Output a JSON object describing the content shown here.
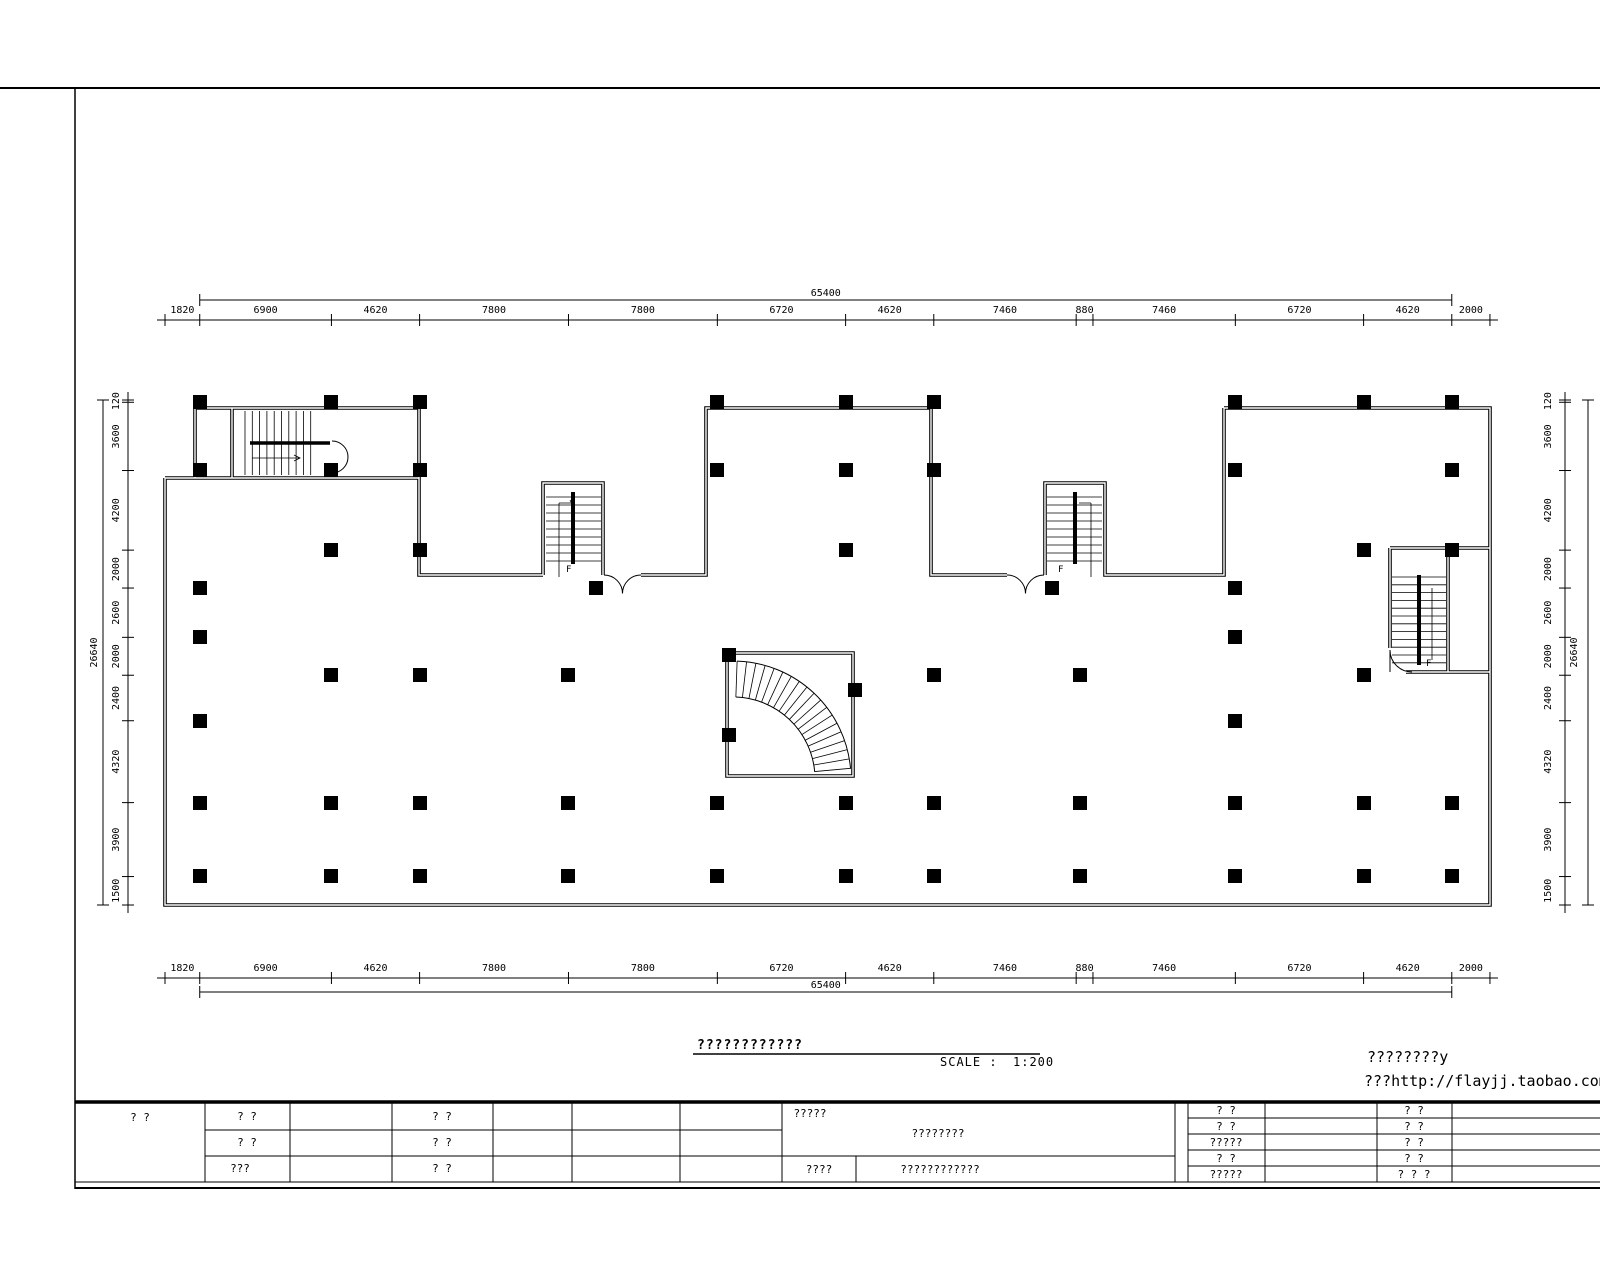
{
  "sheet": {
    "drawing_title": "????????????",
    "scale_label": "SCALE :",
    "scale_value": "1:200"
  },
  "watermark": {
    "line1": "????????y",
    "line2": "???http://flayjj.taobao.com"
  },
  "dimensions": {
    "top": {
      "overall": "65400",
      "segments": [
        1820,
        6900,
        4620,
        7800,
        7800,
        6720,
        4620,
        7460,
        880,
        7460,
        6720,
        4620,
        2000
      ]
    },
    "bottom": {
      "overall": "65400",
      "segments": [
        1820,
        6900,
        4620,
        7800,
        7800,
        6720,
        4620,
        7460,
        880,
        7460,
        6720,
        4620,
        2000
      ]
    },
    "left": {
      "overall": "26640",
      "segments": [
        120,
        3600,
        4200,
        2000,
        2600,
        2000,
        2400,
        4320,
        3900,
        1500
      ]
    },
    "right": {
      "overall": "26640",
      "segments": [
        120,
        3600,
        4200,
        2000,
        2600,
        2000,
        2400,
        4320,
        3900,
        1500
      ]
    }
  },
  "plan": {
    "stair_up_label": "F",
    "columns_px": [
      [
        200,
        402
      ],
      [
        331,
        402
      ],
      [
        420,
        402
      ],
      [
        717,
        402
      ],
      [
        846,
        402
      ],
      [
        934,
        402
      ],
      [
        1235,
        402
      ],
      [
        1364,
        402
      ],
      [
        1452,
        402
      ],
      [
        200,
        470
      ],
      [
        331,
        470
      ],
      [
        420,
        470
      ],
      [
        717,
        470
      ],
      [
        846,
        470
      ],
      [
        934,
        470
      ],
      [
        1235,
        470
      ],
      [
        1452,
        470
      ],
      [
        331,
        550
      ],
      [
        420,
        550
      ],
      [
        846,
        550
      ],
      [
        1364,
        550
      ],
      [
        1452,
        550
      ],
      [
        200,
        588
      ],
      [
        596,
        588
      ],
      [
        1052,
        588
      ],
      [
        1235,
        588
      ],
      [
        200,
        637
      ],
      [
        1235,
        637
      ],
      [
        331,
        675
      ],
      [
        420,
        675
      ],
      [
        568,
        675
      ],
      [
        934,
        675
      ],
      [
        1080,
        675
      ],
      [
        1364,
        675
      ],
      [
        200,
        721
      ],
      [
        1235,
        721
      ],
      [
        729,
        655
      ],
      [
        729,
        735
      ],
      [
        855,
        690
      ],
      [
        200,
        803
      ],
      [
        331,
        803
      ],
      [
        420,
        803
      ],
      [
        568,
        803
      ],
      [
        717,
        803
      ],
      [
        846,
        803
      ],
      [
        934,
        803
      ],
      [
        1080,
        803
      ],
      [
        1235,
        803
      ],
      [
        1364,
        803
      ],
      [
        1452,
        803
      ],
      [
        200,
        876
      ],
      [
        331,
        876
      ],
      [
        420,
        876
      ],
      [
        568,
        876
      ],
      [
        717,
        876
      ],
      [
        846,
        876
      ],
      [
        934,
        876
      ],
      [
        1080,
        876
      ],
      [
        1235,
        876
      ],
      [
        1364,
        876
      ],
      [
        1452,
        876
      ]
    ]
  },
  "titleblock": {
    "col1": "?  ?",
    "col2_rows": [
      "? ?",
      "? ?",
      "???"
    ],
    "col4_rows": [
      "? ?",
      "? ?",
      "? ?"
    ],
    "project_label": "?????",
    "project_name": "????????",
    "row3_label": "????",
    "row3_value": "????????????",
    "rightA": [
      "? ?",
      "? ?",
      "?????",
      "? ?",
      "?????"
    ],
    "rightB": [
      "? ?",
      "? ?",
      "? ?",
      "? ?",
      "? ? ?"
    ]
  }
}
